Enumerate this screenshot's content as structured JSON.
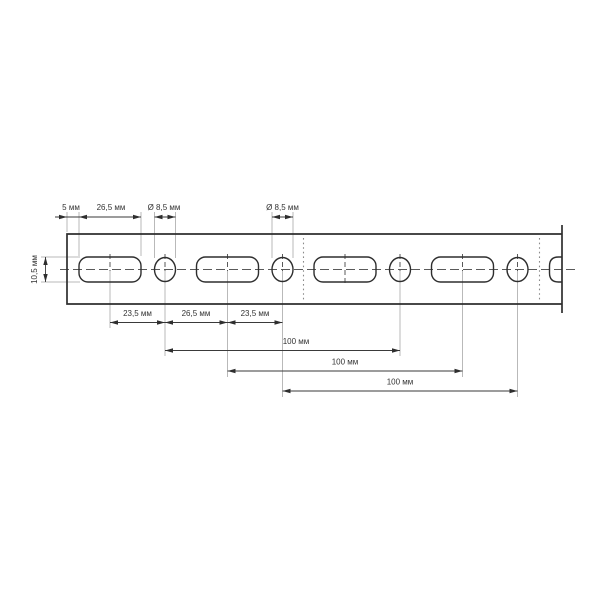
{
  "drawing": {
    "kind": "perforated-mounting-strip-dimension-drawing",
    "unit": "мм",
    "colors": {
      "line": "#2e2e2e",
      "extension": "#b9b9b9",
      "text": "#333333",
      "background": "#ffffff"
    },
    "dimensions": {
      "top": {
        "end_to_slot": "5 мм",
        "slot_length": "26,5 мм",
        "hole_dia_1": "Ø 8,5 мм",
        "hole_dia_2": "Ø 8,5 мм"
      },
      "left": {
        "slot_width": "10,5 мм"
      },
      "bottom": {
        "chain": [
          "23,5 мм",
          "26,5 мм",
          "23,5 мм"
        ],
        "pitch": [
          "100 мм",
          "100 мм",
          "100 мм"
        ]
      }
    }
  }
}
